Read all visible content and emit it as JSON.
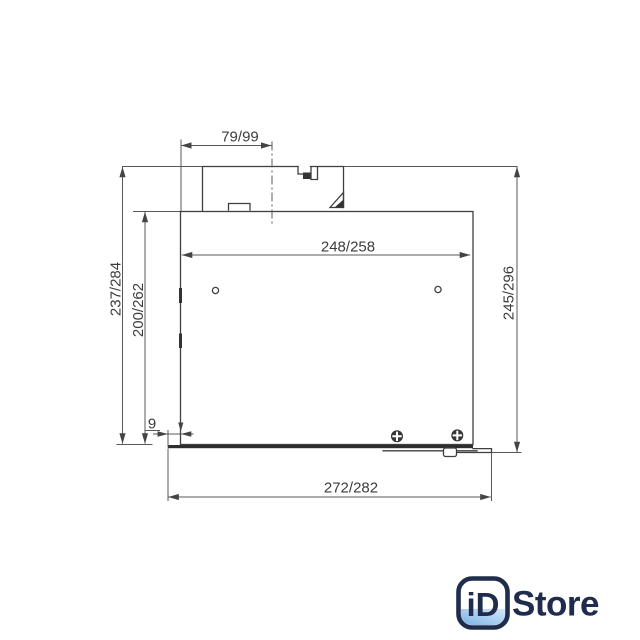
{
  "drawing": {
    "type": "technical-dimension-drawing",
    "dimensions": {
      "top_width": "79/99",
      "inner_width": "248/258",
      "left_outer_height": "237/284",
      "left_inner_height": "200/262",
      "right_height": "245/296",
      "bottom_edge_offset": "9",
      "bottom_width": "272/282"
    },
    "colors": {
      "outline": "#3f3f3f",
      "dimension_lines": "#585858",
      "text": "#3c3c3c"
    }
  },
  "logo": {
    "badge_text": "iD",
    "store_text": "Store",
    "navy": "#202c4c",
    "blue_deep": "#6ea9e2",
    "blue_light": "#d6ebfb"
  }
}
